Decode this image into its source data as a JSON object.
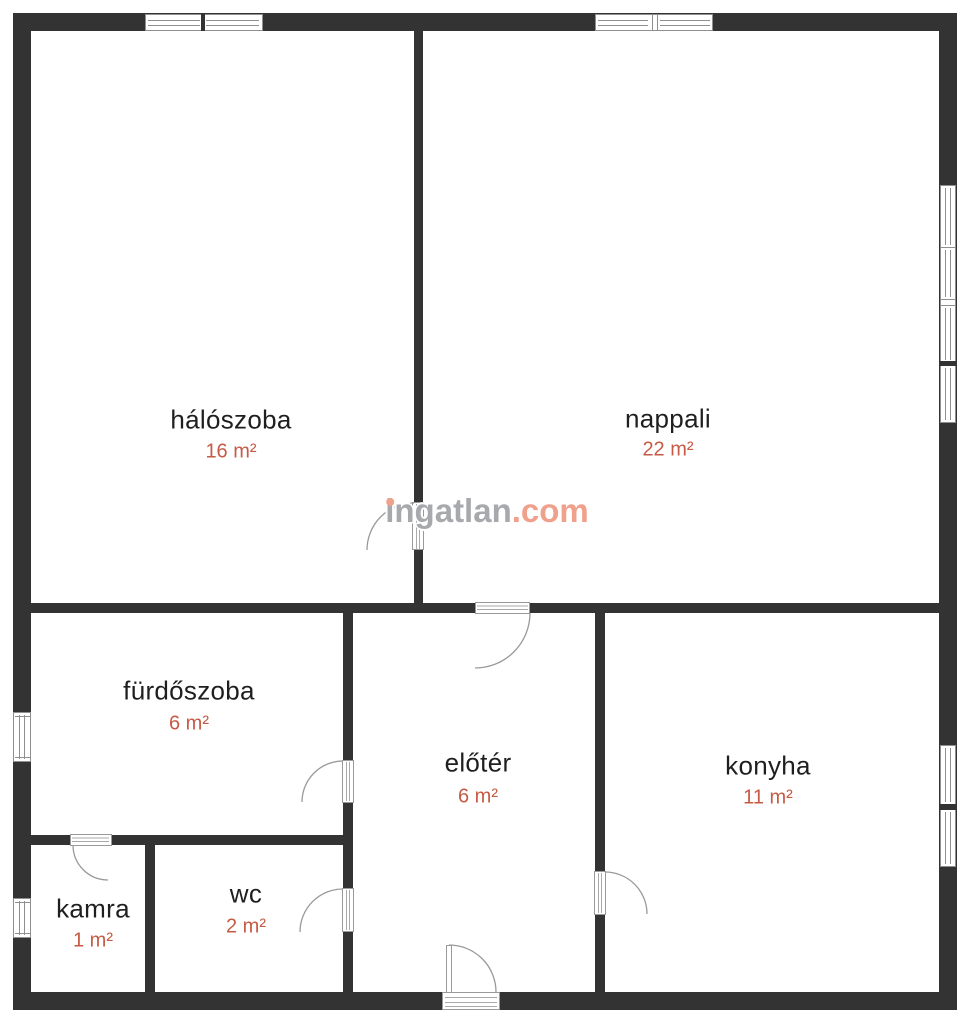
{
  "plan": {
    "rooms": [
      {
        "name": "hálószoba",
        "area": "16 m²"
      },
      {
        "name": "nappali",
        "area": "22 m²"
      },
      {
        "name": "fürdőszoba",
        "area": "6 m²"
      },
      {
        "name": "előtér",
        "area": "6 m²"
      },
      {
        "name": "konyha",
        "area": "11 m²"
      },
      {
        "name": "kamra",
        "area": "1 m²"
      },
      {
        "name": "wc",
        "area": "2 m²"
      }
    ]
  },
  "watermark": {
    "brand": "ingatlan",
    "tld": ".com"
  },
  "colors": {
    "wall": "#333333",
    "room_label": "#1f1f1f",
    "area_value": "#c65b45",
    "frame": "#8f8f8f",
    "watermark_gray": "#a7a9ac",
    "watermark_salmon": "#f0a18c",
    "background": "#ffffff"
  }
}
